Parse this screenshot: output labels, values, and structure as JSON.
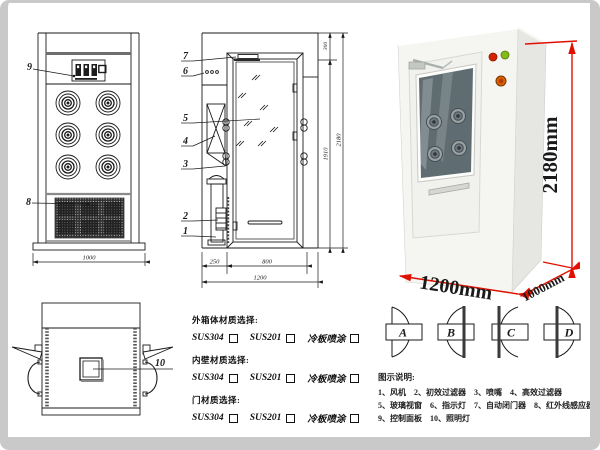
{
  "colors": {
    "dimension_red": "#e01000",
    "line": "#1a1a1a",
    "indicator_red": "#d42300",
    "indicator_green": "#86b919",
    "button_orange": "#d95f00",
    "frame_gray": "#c9c9c9"
  },
  "front_view": {
    "callout_9": "9",
    "callout_8": "8",
    "dim_width": "1000"
  },
  "side_view": {
    "callout_7": "7",
    "callout_6": "6",
    "callout_5": "5",
    "callout_4": "4",
    "callout_3": "3",
    "callout_2": "2",
    "callout_1": "1",
    "dim_top": "300",
    "dim_door_height": "1910",
    "dim_total_height": "2180",
    "dim_left": "250",
    "dim_door_width": "800",
    "dim_total_width": "1200"
  },
  "top_view": {
    "callout_10": "10"
  },
  "photo": {
    "dim_height": "2180mm",
    "dim_width": "1200mm",
    "dim_depth": "1000mm"
  },
  "materials": {
    "groups": [
      {
        "title": "外箱体材质选择:",
        "options": [
          "SUS304",
          "SUS201",
          "冷板喷涂"
        ]
      },
      {
        "title": "内壁材质选择:",
        "options": [
          "SUS304",
          "SUS201",
          "冷板喷涂"
        ]
      },
      {
        "title": "门材质选择:",
        "options": [
          "SUS304",
          "SUS201",
          "冷板喷涂"
        ]
      }
    ]
  },
  "door_configs": {
    "labels": [
      "A",
      "B",
      "C",
      "D"
    ]
  },
  "parts_legend": {
    "title": "图示说明:",
    "lines": [
      [
        "1、风机",
        "2、初效过滤器",
        "3、喷嘴",
        "4、高效过滤器"
      ],
      [
        "5、玻璃视窗",
        "6、指示灯",
        "7、自动闭门器",
        "8、红外线感应器"
      ],
      [
        "9、控制面板",
        "10、照明灯"
      ]
    ]
  }
}
